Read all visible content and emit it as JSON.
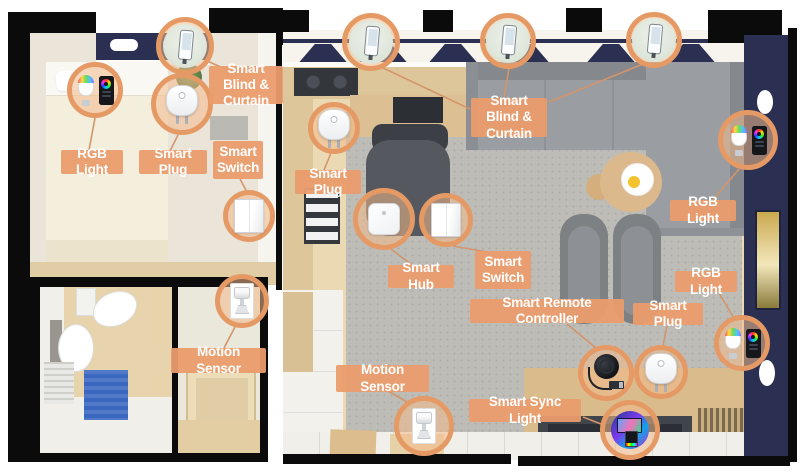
{
  "colors": {
    "accent": "rgba(234,156,107,0.95)",
    "ring": "#e59a66",
    "circle-fill": "rgba(242,186,139,0.55)",
    "wall": "#0b0b0c",
    "navy": "#2b3053",
    "wood": "#ebd9b3",
    "wood-dark": "#ddc79a",
    "rug": "#bdbcb7",
    "tile": "#f1efe9",
    "bedroom-floor": "#ebe5d9",
    "bed": "#f4eedd",
    "bath-tile": "#e7d3ac",
    "bath-mat-blue": "#3a67bf",
    "line": "#d4956b"
  },
  "labels": [
    {
      "id": "blind-curtain-bedroom",
      "text": "Smart Blind & Curtain",
      "x": 209,
      "y": 66,
      "w": 74,
      "h": 38
    },
    {
      "id": "rgb-light-bedroom",
      "text": "RGB Light",
      "x": 61,
      "y": 150,
      "w": 62,
      "h": 24
    },
    {
      "id": "smart-plug-bedroom",
      "text": "Smart Plug",
      "x": 139,
      "y": 150,
      "w": 68,
      "h": 24
    },
    {
      "id": "smart-switch-bedroom",
      "text": "Smart Switch",
      "x": 213,
      "y": 141,
      "w": 50,
      "h": 38
    },
    {
      "id": "smart-plug-kitchen",
      "text": "Smart Plug",
      "x": 295,
      "y": 170,
      "w": 66,
      "h": 24
    },
    {
      "id": "blind-curtain-living",
      "text": "Smart Blind & Curtain",
      "x": 471,
      "y": 98,
      "w": 76,
      "h": 39
    },
    {
      "id": "rgb-light-sofa",
      "text": "RGB Light",
      "x": 670,
      "y": 200,
      "w": 66,
      "h": 21
    },
    {
      "id": "smart-hub",
      "text": "Smart Hub",
      "x": 388,
      "y": 265,
      "w": 66,
      "h": 23
    },
    {
      "id": "smart-switch-living",
      "text": "Smart Switch",
      "x": 475,
      "y": 251,
      "w": 56,
      "h": 38
    },
    {
      "id": "rgb-light-wall",
      "text": "RGB Light",
      "x": 675,
      "y": 271,
      "w": 62,
      "h": 21
    },
    {
      "id": "smart-remote-controller",
      "text": "Smart Remote Controller",
      "x": 470,
      "y": 299,
      "w": 154,
      "h": 24
    },
    {
      "id": "smart-plug-living",
      "text": "Smart Plug",
      "x": 633,
      "y": 303,
      "w": 70,
      "h": 22
    },
    {
      "id": "motion-sensor-bathroom",
      "text": "Motion Sensor",
      "x": 171,
      "y": 348,
      "w": 95,
      "h": 25
    },
    {
      "id": "motion-sensor-living",
      "text": "Motion Sensor",
      "x": 336,
      "y": 365,
      "w": 93,
      "h": 27
    },
    {
      "id": "smart-sync-light",
      "text": "Smart Sync Light",
      "x": 469,
      "y": 399,
      "w": 112,
      "h": 23
    }
  ],
  "devices": [
    {
      "id": "blind-phone-bedroom",
      "type": "blind-phone",
      "cx": 185,
      "cy": 46,
      "r": 29
    },
    {
      "id": "rgb-bulb-bedroom",
      "type": "rgb-bulb",
      "cx": 95,
      "cy": 90,
      "r": 28
    },
    {
      "id": "smart-plug-bedroom",
      "type": "smart-plug",
      "cx": 182,
      "cy": 104,
      "r": 31
    },
    {
      "id": "smart-switch-bedroom",
      "type": "smart-switch",
      "cx": 249,
      "cy": 216,
      "r": 26
    },
    {
      "id": "smart-plug-kitchen",
      "type": "smart-plug",
      "cx": 334,
      "cy": 128,
      "r": 26
    },
    {
      "id": "blind-phone-living-1",
      "type": "blind-phone",
      "cx": 371,
      "cy": 42,
      "r": 29
    },
    {
      "id": "blind-phone-living-2",
      "type": "blind-phone",
      "cx": 508,
      "cy": 41,
      "r": 28
    },
    {
      "id": "blind-phone-living-3",
      "type": "blind-phone",
      "cx": 654,
      "cy": 40,
      "r": 28
    },
    {
      "id": "smart-hub",
      "type": "smart-hub",
      "cx": 384,
      "cy": 219,
      "r": 31
    },
    {
      "id": "smart-switch-living",
      "type": "smart-switch",
      "cx": 446,
      "cy": 220,
      "r": 27
    },
    {
      "id": "rgb-bulb-sofa",
      "type": "rgb-bulb",
      "cx": 748,
      "cy": 140,
      "r": 30
    },
    {
      "id": "rgb-bulb-wall",
      "type": "rgb-bulb",
      "cx": 742,
      "cy": 343,
      "r": 28
    },
    {
      "id": "motion-sensor-bathroom",
      "type": "motion-sensor",
      "cx": 242,
      "cy": 301,
      "r": 27
    },
    {
      "id": "motion-sensor-living",
      "type": "motion-sensor",
      "cx": 424,
      "cy": 426,
      "r": 30
    },
    {
      "id": "smart-remote-controller",
      "type": "remote-controller",
      "cx": 606,
      "cy": 373,
      "r": 28
    },
    {
      "id": "smart-plug-living",
      "type": "smart-plug",
      "cx": 661,
      "cy": 372,
      "r": 27
    },
    {
      "id": "smart-sync-light",
      "type": "sync-light",
      "cx": 630,
      "cy": 430,
      "r": 30
    }
  ],
  "connectors": [
    [
      205,
      60,
      232,
      72
    ],
    [
      95,
      118,
      89,
      150
    ],
    [
      178,
      135,
      170,
      151
    ],
    [
      240,
      179,
      247,
      192
    ],
    [
      331,
      153,
      324,
      170
    ],
    [
      381,
      67,
      470,
      109
    ],
    [
      509,
      68,
      504,
      98
    ],
    [
      643,
      64,
      549,
      102
    ],
    [
      391,
      249,
      412,
      265
    ],
    [
      453,
      246,
      487,
      252
    ],
    [
      739,
      169,
      713,
      200
    ],
    [
      735,
      320,
      719,
      293
    ],
    [
      235,
      327,
      224,
      348
    ],
    [
      409,
      403,
      388,
      391
    ],
    [
      597,
      349,
      567,
      324
    ],
    [
      663,
      346,
      667,
      326
    ],
    [
      601,
      424,
      583,
      417
    ]
  ]
}
